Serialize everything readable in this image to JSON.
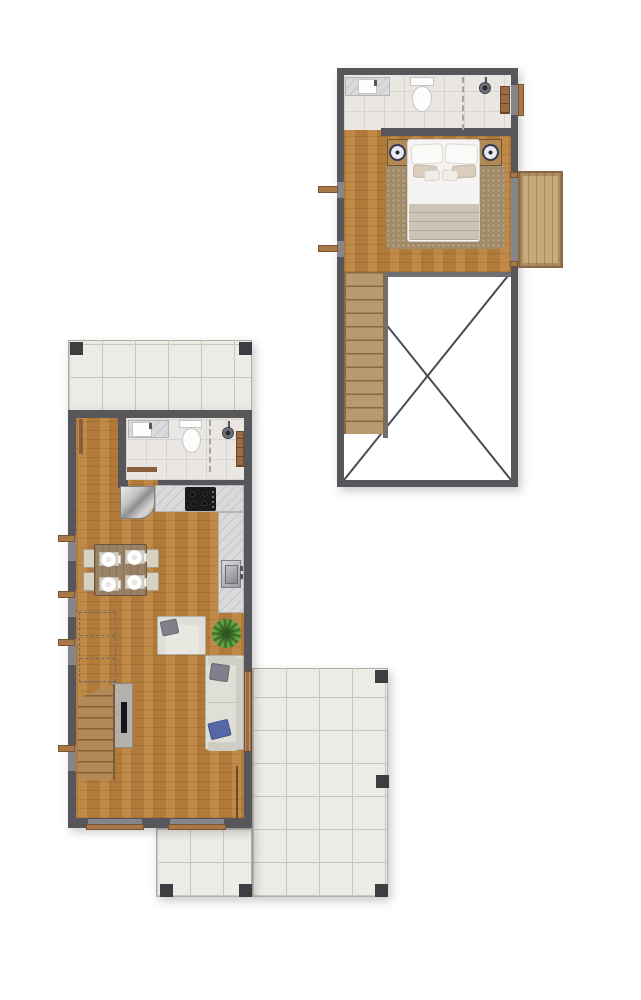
{
  "document": {
    "type": "architectural-floor-plan",
    "floors_shown": 2,
    "text_labels": [],
    "background": "#ffffff"
  },
  "palette": {
    "wall": "#57575b",
    "post": "#3e3e42",
    "wood_floor": "#b8813f",
    "deck_wood": "#c7aa7b",
    "stair_wood": "#b28a58",
    "bathroom_tile": "#eae7e3",
    "patio_tile": "#edebe6",
    "counter_marble": "#dadadc",
    "sofa_fabric": "#e0dfd7",
    "pillow_gray": "#80808c",
    "pillow_blue": "#5468a6",
    "rug": "#a28b68",
    "plant_green": "#4e8a35",
    "door_wood": "#8b5e3c",
    "cooktop_black": "#1b1b1d"
  },
  "upper_floor_plan": {
    "position": "top-right of sheet",
    "rooms": [
      {
        "name": "bathroom",
        "floor": "tile",
        "fixtures": [
          "vanity-counter",
          "basin-sink",
          "faucet",
          "toilet",
          "glass-partition-dashed",
          "shower-head",
          "shelf-closet",
          "window-sill-right"
        ]
      },
      {
        "name": "bedroom",
        "floor": "wood",
        "furniture": [
          "double-bed",
          "pillows-white-x2",
          "pillows-beige-x2",
          "pillows-small-x2",
          "blanket",
          "nightstand-left",
          "nightstand-right",
          "lamp-left",
          "lamp-right",
          "area-rug",
          "window-sills-left-x2"
        ]
      },
      {
        "name": "balcony",
        "floor": "wood-deck",
        "features": [
          "door-thresholds"
        ]
      },
      {
        "name": "void-open-to-below",
        "markers": [
          "diagonal-cross-lines"
        ],
        "features": [
          "staircase-down",
          "railing-wall"
        ]
      }
    ]
  },
  "ground_floor_plan": {
    "position": "bottom-left of sheet",
    "rooms": [
      {
        "name": "entry-patio-top",
        "floor": "tile",
        "features": [
          "corner-posts-x2"
        ]
      },
      {
        "name": "entry-hall",
        "floor": "wood",
        "features": [
          "entry-door-leaf"
        ]
      },
      {
        "name": "bathroom",
        "floor": "tile",
        "fixtures": [
          "vanity-counter",
          "basin-sink",
          "toilet",
          "glass-partition-dashed",
          "shower-head",
          "shelf-closet",
          "sliding-door"
        ]
      },
      {
        "name": "kitchen",
        "floor": "wood",
        "fixtures": [
          "refrigerator",
          "counter-top-run",
          "cooktop-4-burners",
          "counter-right-run",
          "kitchen-sink",
          "faucet"
        ]
      },
      {
        "name": "dining",
        "floor": "wood",
        "furniture": [
          "table",
          "chairs-x4",
          "placemats-x4",
          "plates-x4"
        ]
      },
      {
        "name": "living",
        "floor": "wood",
        "furniture": [
          "armchair",
          "gray-cushion",
          "sofa",
          "gray-pillow",
          "blue-pillow",
          "potted-plant",
          "tv-panel",
          "tv-screen",
          "staircase-up",
          "stair-projection-dashed",
          "side-door-leaf",
          "sliding-glass-door"
        ]
      },
      {
        "name": "terrace-bottom-right",
        "floor": "tile",
        "features": [
          "posts-x5"
        ]
      }
    ],
    "openings": [
      "window-sills-left-x4",
      "bottom-windows-x2"
    ]
  }
}
